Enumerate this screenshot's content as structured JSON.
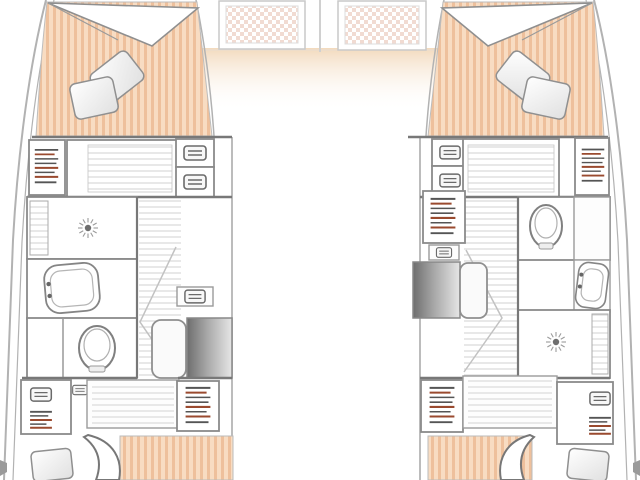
{
  "meta": {
    "title": "Catamaran lower-deck floor plan",
    "diagram_type": "boat-floor-plan",
    "view": "top-down",
    "visible_text": []
  },
  "colors": {
    "background": "#ffffff",
    "hull_line": "#b2b2b2",
    "wall": "#787878",
    "mattress_base": "#f8dcc2",
    "mattress_stripe": "#eec09c",
    "hatch_dot": "#f1dbd2",
    "deck_glow": "#f2d8ba",
    "floor_line": "#d6d6d6",
    "steps_dark": "#6e6e6e",
    "steps_light": "#e6e6e6",
    "accent_rust": "#9a4a2f",
    "glyph_dark": "#555555",
    "fixture_fill": "#ffffff"
  },
  "bridgedeck": {
    "elements": [
      "forward-hatch-port",
      "forward-hatch-starboard",
      "deck-glow"
    ]
  },
  "port_hull": {
    "areas": [
      "forward-cabin",
      "lockers-row",
      "shower-room",
      "washbasin-room",
      "wc-room",
      "companionway",
      "aft-lockers-row",
      "aft-cabin"
    ],
    "fixtures": [
      "double-berth",
      "pillow",
      "pillow",
      "shelf-locker",
      "slatted-panel",
      "drawer-cabinet",
      "drawer-cabinet",
      "shower-drain",
      "washbasin",
      "toilet",
      "steps",
      "seat",
      "shelf-locker",
      "aft-berth",
      "pillow"
    ]
  },
  "starboard_hull": {
    "areas": [
      "forward-cabin",
      "lockers-row",
      "wc-room",
      "washbasin-room",
      "shower-room",
      "companionway",
      "aft-lockers-row",
      "aft-cabin"
    ],
    "fixtures": [
      "double-berth",
      "pillow",
      "pillow",
      "shelf-locker",
      "slatted-panel",
      "drawer-cabinet",
      "drawer-cabinet",
      "toilet",
      "washbasin",
      "shower-drain",
      "steps",
      "seat",
      "shelf-locker",
      "aft-berth",
      "pillow"
    ]
  }
}
